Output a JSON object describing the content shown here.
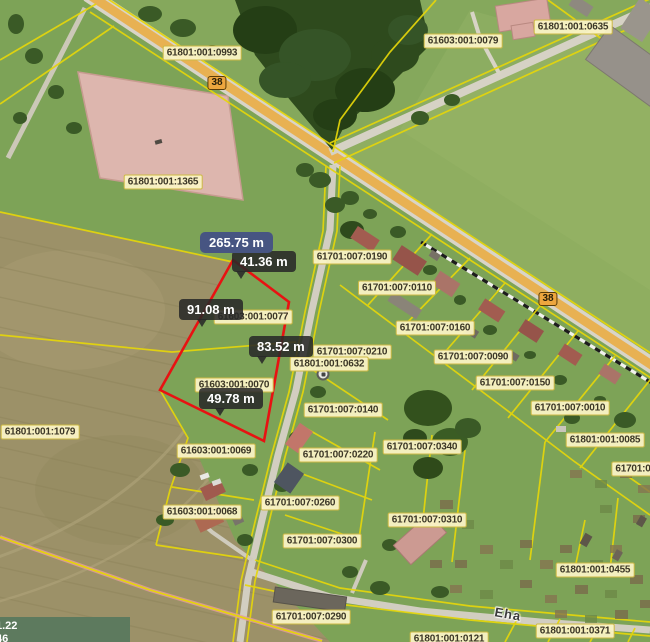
{
  "parcel_labels": [
    {
      "code": "61801:001:0993",
      "x": 202,
      "y": 53
    },
    {
      "code": "61603:001:0079",
      "x": 463,
      "y": 41
    },
    {
      "code": "61801:001:0635",
      "x": 573,
      "y": 27
    },
    {
      "code": "61801:001:1365",
      "x": 163,
      "y": 182
    },
    {
      "code": "61801:001:1079",
      "x": 40,
      "y": 432
    },
    {
      "code": "61701:007:0190",
      "x": 352,
      "y": 257
    },
    {
      "code": "61701:007:0110",
      "x": 397,
      "y": 288
    },
    {
      "code": "61701:007:0160",
      "x": 435,
      "y": 328
    },
    {
      "code": "61701:007:0210",
      "x": 352,
      "y": 352
    },
    {
      "code": "61701:007:0090",
      "x": 473,
      "y": 357
    },
    {
      "code": "61701:007:0150",
      "x": 515,
      "y": 383
    },
    {
      "code": "61701:007:0010",
      "x": 570,
      "y": 408
    },
    {
      "code": "61801:001:0632",
      "x": 329,
      "y": 364
    },
    {
      "code": "61701:007:0140",
      "x": 343,
      "y": 410
    },
    {
      "code": "61603:001:0077",
      "x": 253,
      "y": 317
    },
    {
      "code": "61603:001:0070",
      "x": 234,
      "y": 385
    },
    {
      "code": "61603:001:0069",
      "x": 216,
      "y": 451
    },
    {
      "code": "61603:001:0068",
      "x": 202,
      "y": 512
    },
    {
      "code": "61701:007:0220",
      "x": 338,
      "y": 455
    },
    {
      "code": "61701:007:0340",
      "x": 422,
      "y": 447
    },
    {
      "code": "61701:007:0260",
      "x": 300,
      "y": 503
    },
    {
      "code": "61701:007:0310",
      "x": 427,
      "y": 520
    },
    {
      "code": "61701:007:0300",
      "x": 322,
      "y": 541
    },
    {
      "code": "61801:001:0085",
      "x": 605,
      "y": 440
    },
    {
      "code": "61701:0",
      "x": 633,
      "y": 469
    },
    {
      "code": "61801:001:0455",
      "x": 595,
      "y": 570
    },
    {
      "code": "61701:007:0290",
      "x": 311,
      "y": 617
    },
    {
      "code": "61801:001:0371",
      "x": 575,
      "y": 631
    },
    {
      "code": "61801:001:0121",
      "x": 449,
      "y": 639
    }
  ],
  "road_badges": [
    {
      "text": "38",
      "x": 217,
      "y": 83
    },
    {
      "text": "38",
      "x": 548,
      "y": 299
    }
  ],
  "street_label": {
    "text": "Eha",
    "x": 508,
    "y": 614
  },
  "measurements": {
    "total_label": "265.75 m",
    "total_pos": {
      "x": 200,
      "y": 232
    },
    "segments": [
      {
        "label": "41.36 m",
        "x": 232,
        "y": 251,
        "tail_x": 4
      },
      {
        "label": "91.08 m",
        "x": 179,
        "y": 299,
        "tail_x": 18
      },
      {
        "label": "83.52 m",
        "x": 249,
        "y": 336,
        "tail_x": 8
      },
      {
        "label": "49.78 m",
        "x": 199,
        "y": 388,
        "tail_x": 16
      }
    ]
  },
  "coordinate_readout": {
    "line1": "1.22",
    "line2": "46"
  },
  "map_icons": [
    {
      "name": "bus-stop-icon",
      "x": 341,
      "y": 354
    },
    {
      "name": "bus-stop-icon",
      "x": 323,
      "y": 374
    }
  ],
  "colors": {
    "measure_line": "#e81212",
    "boundary_yellow": "#e6d60a",
    "total_badge_bg": "#475582",
    "tooltip_bg": "#2a2a2a",
    "parcel_label_bg": "#faf3c5",
    "highlighted_parcel_fill": "#ddb6ae",
    "road_fill": "#e8b152"
  }
}
